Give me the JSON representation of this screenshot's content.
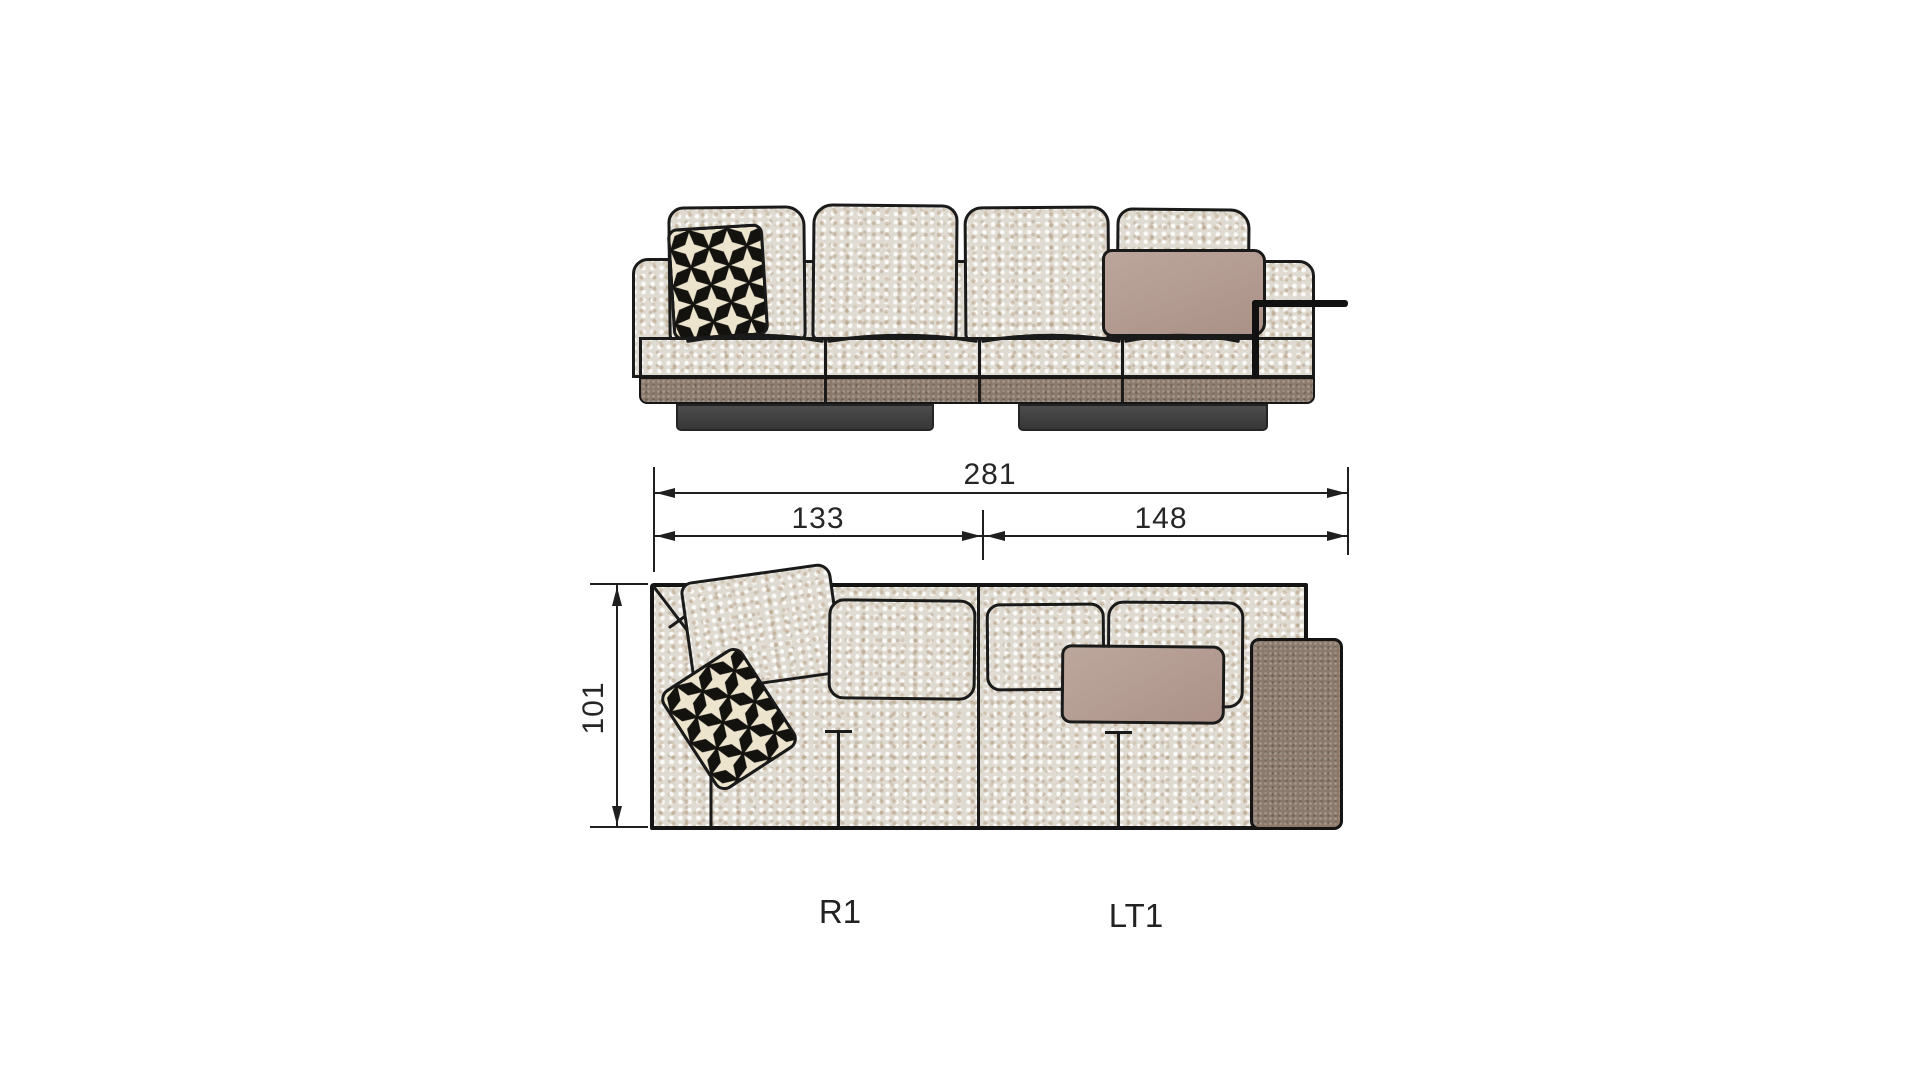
{
  "title": "sectional-sofa-dimension-diagram",
  "dimensions": {
    "overall_width": "281",
    "module_left_width": "133",
    "module_right_width": "148",
    "depth": "101"
  },
  "modules": {
    "left_label": "R1",
    "right_label": "LT1"
  },
  "colors": {
    "fabric_base": "#e0dbd2",
    "leather_brown": "#8b7a6c",
    "mauve_pillow": "#b49a90",
    "black_pillow": "#14120f",
    "star_cream": "#ece4cd",
    "foot_gray": "#3f3e3d",
    "line": "#1a1a1a",
    "background": "#ffffff"
  }
}
